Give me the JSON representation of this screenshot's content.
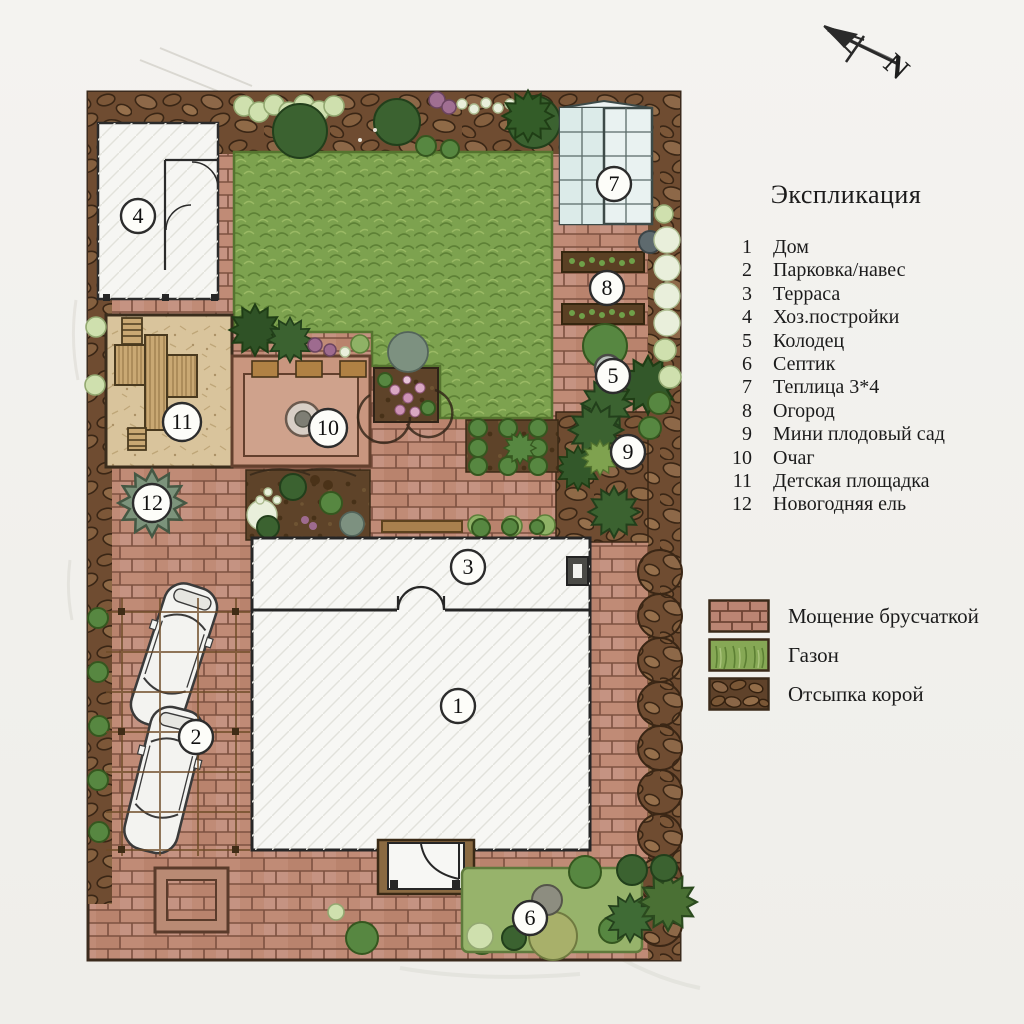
{
  "legend": {
    "title": "Экспликация",
    "items": [
      {
        "num": "1",
        "label": "Дом"
      },
      {
        "num": "2",
        "label": "Парковка/навес"
      },
      {
        "num": "3",
        "label": "Терраса"
      },
      {
        "num": "4",
        "label": "Хоз.постройки"
      },
      {
        "num": "5",
        "label": "Колодец"
      },
      {
        "num": "6",
        "label": "Септик"
      },
      {
        "num": "7",
        "label": "Теплица 3*4"
      },
      {
        "num": "8",
        "label": "Огород"
      },
      {
        "num": "9",
        "label": "Мини плодовый сад"
      },
      {
        "num": "10",
        "label": "Очаг"
      },
      {
        "num": "11",
        "label": "Детская площадка"
      },
      {
        "num": "12",
        "label": "Новогодняя ель"
      }
    ]
  },
  "materials": [
    {
      "label": "Мощение брусчаткой",
      "type": "brick-paving",
      "color": "#bb8573"
    },
    {
      "label": "Газон",
      "type": "lawn",
      "color": "#86a855"
    },
    {
      "label": "Отсыпка корой",
      "type": "bark-mulch",
      "color": "#5f422a"
    }
  ],
  "markers": [
    "1",
    "2",
    "3",
    "4",
    "5",
    "6",
    "7",
    "8",
    "9",
    "10",
    "11",
    "12"
  ],
  "north_label": "N",
  "colors": {
    "brick": "#c08b76",
    "lawn": "#7da24f",
    "bark": "#6f4c31",
    "sand": "#d9c49c"
  }
}
